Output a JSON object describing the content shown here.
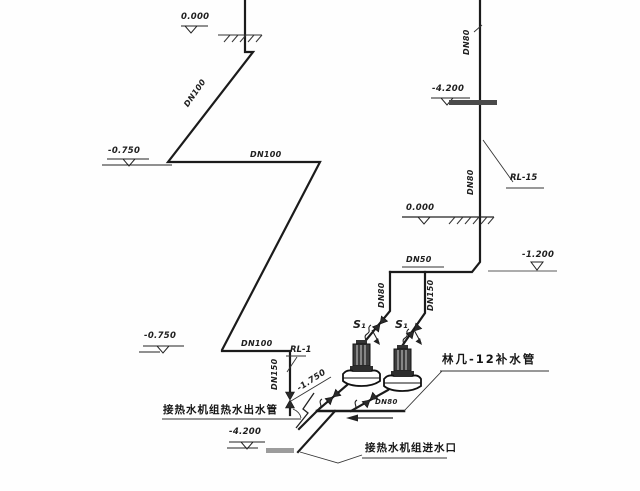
{
  "drawing": {
    "elevations": {
      "top_left": "0.000",
      "upper_left": "-0.750",
      "riser_top": "-4.200",
      "riser_ground": "0.000",
      "branch": "-1.200",
      "lower_left": "-0.750",
      "slope": "-1.750",
      "bottom": "-4.200"
    },
    "pipes": {
      "top_diagonal": "DN100",
      "upper_horizontal": "DN100",
      "lower_horizontal": "DN100",
      "outlet_riser": "DN150",
      "riser_top": "DN80",
      "riser_mid": "DN80",
      "branch_horizontal": "DN50",
      "pump_inlet_left": "DN80",
      "pump_inlet_right": "DN150",
      "pump_header": "DN80"
    },
    "refs": {
      "rl_1": "RL-1",
      "rl_15": "RL-15"
    },
    "pumps": {
      "pump_1": "S₁",
      "pump_2": "S₁"
    },
    "notes": {
      "makeup_pipe": "林几-12补水管",
      "hot_water_outlet": "接热水机组热水出水管",
      "unit_inlet": "接热水机组进水口"
    }
  }
}
